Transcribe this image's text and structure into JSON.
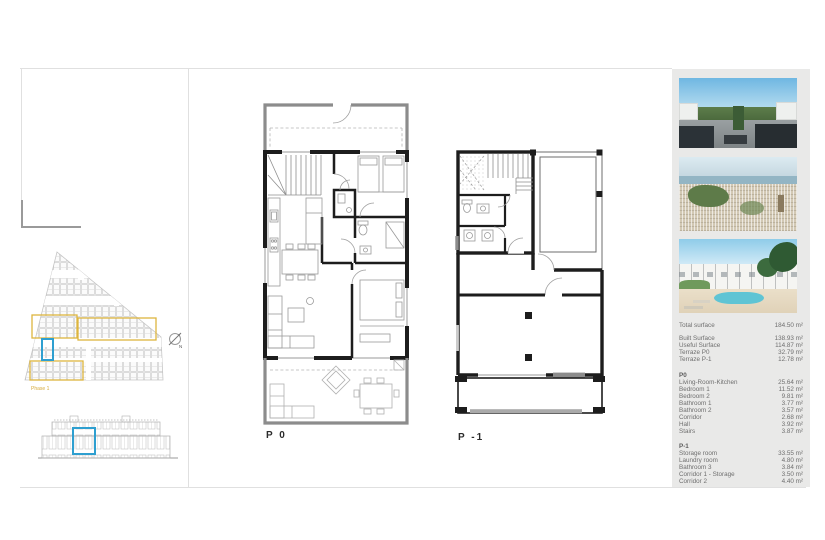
{
  "site_plan": {
    "phase_label": "Phase 1",
    "north_label": "N"
  },
  "plans": {
    "p0_caption": "P 0",
    "p1_caption": "P -1"
  },
  "sidebar": {
    "total_label": "Total surface",
    "total_value": "184.50 m²",
    "surfaces": [
      {
        "label": "Built Surface",
        "value": "138.93 m²"
      },
      {
        "label": "Useful Surface",
        "value": "114.87 m²"
      },
      {
        "label": "Terraze P0",
        "value": "32.79 m²"
      },
      {
        "label": "Terraze P-1",
        "value": "12.78 m²"
      }
    ],
    "p0_header": "P0",
    "p0_rows": [
      {
        "label": "Living-Room-Kitchen",
        "value": "25.64 m²"
      },
      {
        "label": "Bedroom 1",
        "value": "11.52 m²"
      },
      {
        "label": "Bedroom 2",
        "value": "9.81 m²"
      },
      {
        "label": "Bathroom 1",
        "value": "3.77 m²"
      },
      {
        "label": "Bathroom 2",
        "value": "3.57 m²"
      },
      {
        "label": "Corridor",
        "value": "2.68 m²"
      },
      {
        "label": "Hall",
        "value": "3.92 m²"
      },
      {
        "label": "Stairs",
        "value": "3.87 m²"
      }
    ],
    "p1_header": "P-1",
    "p1_rows": [
      {
        "label": "Storage room",
        "value": "33.55 m²"
      },
      {
        "label": "Laundry room",
        "value": "4.80 m²"
      },
      {
        "label": "Bathroom 3",
        "value": "3.84 m²"
      },
      {
        "label": "Corridor 1 - Storage",
        "value": "3.50 m²"
      },
      {
        "label": "Corridor 2",
        "value": "4.40 m²"
      }
    ]
  },
  "colors": {
    "highlight_blue": "#2e9fd0",
    "highlight_yellow": "#ddb53f",
    "wall_black": "#1d1d1d",
    "terrace_gray": "#8c8c8c",
    "sidebar_bg": "#e9e9e8"
  }
}
